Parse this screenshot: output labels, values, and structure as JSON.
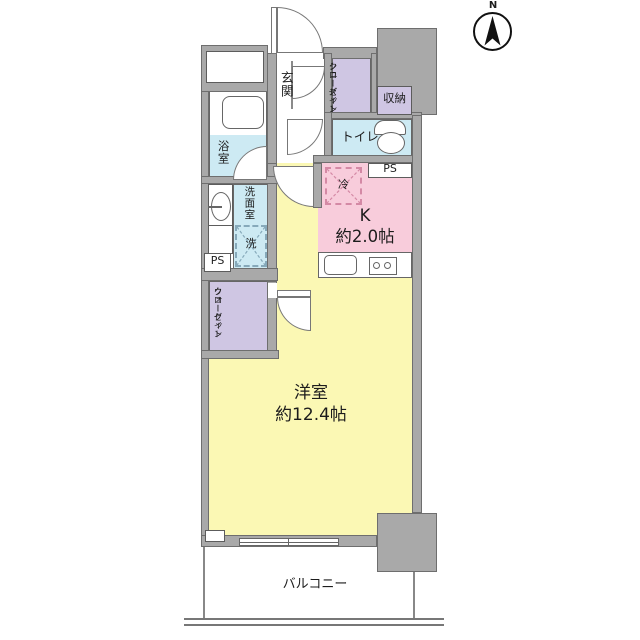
{
  "floor_plan": {
    "compass": {
      "north_label": "N"
    },
    "rooms": {
      "genkan": {
        "label": "玄関"
      },
      "shoes_closet": {
        "line1": "シューズイン",
        "line2": "クローゼット"
      },
      "storage": {
        "label": "収納"
      },
      "toilet": {
        "label": "トイレ"
      },
      "bathroom": {
        "label": "浴室"
      },
      "washroom": {
        "label": "洗面室"
      },
      "kitchen": {
        "label": "K",
        "size": "約2.0帖"
      },
      "walk_in_closet": {
        "line1": "ウォークイン",
        "line2": "クローゼット"
      },
      "main_room": {
        "label": "洋室",
        "size": "約12.4帖"
      },
      "balcony": {
        "label": "バルコニー"
      }
    },
    "fixtures": {
      "refrigerator": "冷",
      "washer": "洗",
      "pipe_space_right": "PS",
      "pipe_space_left": "PS"
    },
    "colors": {
      "wall": "#a9a9a9",
      "room_yellow": "#fbf8b4",
      "room_pink": "#f8ccdb",
      "room_blue": "#cdeaf3",
      "room_purple": "#cfc6e3"
    }
  }
}
